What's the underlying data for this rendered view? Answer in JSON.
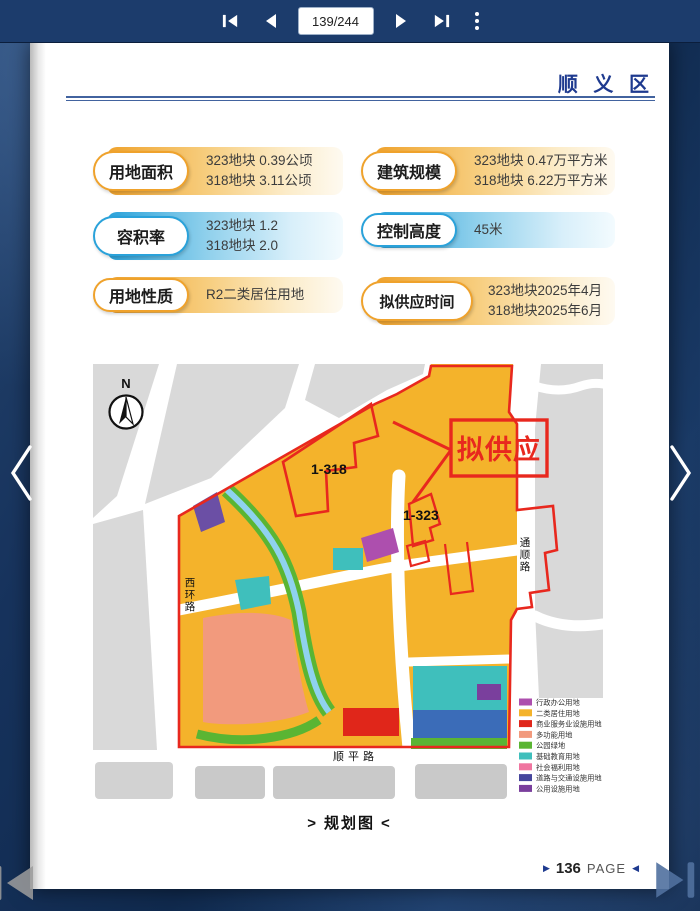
{
  "toolbar": {
    "page_indicator": "139/244"
  },
  "page": {
    "header_title": "顺 义 区",
    "cards": [
      {
        "label": "用地面积",
        "line1": "323地块 0.39公顷",
        "line2": "318地块 3.11公顷"
      },
      {
        "label": "建筑规模",
        "line1": "323地块 0.47万平方米",
        "line2": "318地块 6.22万平方米"
      },
      {
        "label": "容积率",
        "line1": "323地块 1.2",
        "line2": "318地块 2.0"
      },
      {
        "label": "控制高度",
        "line1": "45米",
        "line2": ""
      },
      {
        "label": "用地性质",
        "line1": "R2二类居住用地",
        "line2": ""
      },
      {
        "label": "拟供应时间",
        "line1": "323地块2025年4月",
        "line2": "318地块2025年6月"
      }
    ],
    "map": {
      "compass_label": "N",
      "parcel_318_label": "1-318",
      "parcel_323_label": "1-323",
      "callout_label": "拟供应",
      "roads": {
        "west": "西环路",
        "east": "通顺路",
        "south": "顺平路"
      },
      "legend": [
        {
          "label": "行政办公用地",
          "color": "#ad4fae"
        },
        {
          "label": "二类居住用地",
          "color": "#f4b32b"
        },
        {
          "label": "商业服务业设施用地",
          "color": "#e0261a"
        },
        {
          "label": "多功能用地",
          "color": "#f29a7d"
        },
        {
          "label": "公园绿地",
          "color": "#5ab533"
        },
        {
          "label": "基础教育用地",
          "color": "#3fbfbc"
        },
        {
          "label": "社会福利用地",
          "color": "#f075a0"
        },
        {
          "label": "道路与交通设施用地",
          "color": "#46469c"
        },
        {
          "label": "公用设施用地",
          "color": "#7a3f9d"
        }
      ]
    },
    "caption": "规划图",
    "caption_arrow_left": ">",
    "caption_arrow_right": "<",
    "footer": {
      "arrow_left": "▶",
      "page_number": "136",
      "page_label": "PAGE",
      "arrow_right": "◀"
    }
  },
  "colors": {
    "chrome_navy": "#1c3c6c",
    "header_blue": "#1e3a8f",
    "card_orange": "#efa22c",
    "card_blue": "#2aa2da",
    "boundary_red": "#e8281e"
  }
}
